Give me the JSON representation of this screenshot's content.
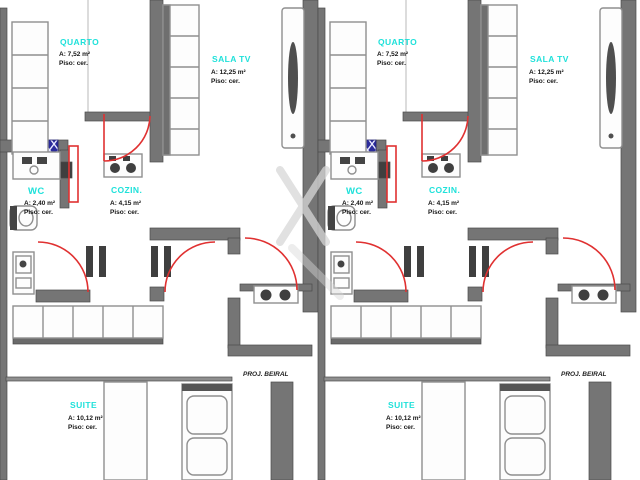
{
  "floorplan": {
    "type": "residential-floor-plan",
    "units": [
      {
        "label": "unit-a"
      },
      {
        "label": "unit-b"
      }
    ],
    "rooms": {
      "quarto": {
        "name": "QUARTO",
        "area": "A: 7,52 m²",
        "floor": "Piso: cer."
      },
      "sala_tv": {
        "name": "SALA TV",
        "area": "A: 12,25 m²",
        "floor": "Piso: cer."
      },
      "wc": {
        "name": "WC",
        "area": "A: 2,40 m²",
        "floor": "Piso: cer."
      },
      "cozinha": {
        "name": "COZIN.",
        "area": "A: 4,15 m²",
        "floor": "Piso: cer."
      },
      "suite": {
        "name": "SUITE",
        "area": "A: 10,12 m²",
        "floor": "Piso: cer."
      }
    },
    "annotations": {
      "eave_note": "PROJ. BEIRAL"
    },
    "colors": {
      "wall": "#757575",
      "wall_dark": "#3f3f3f",
      "door": "#e03131",
      "room_label": "#1fe1da",
      "area_text": "#151515",
      "window": "#2b2b9b",
      "background": "#ffffff"
    }
  }
}
